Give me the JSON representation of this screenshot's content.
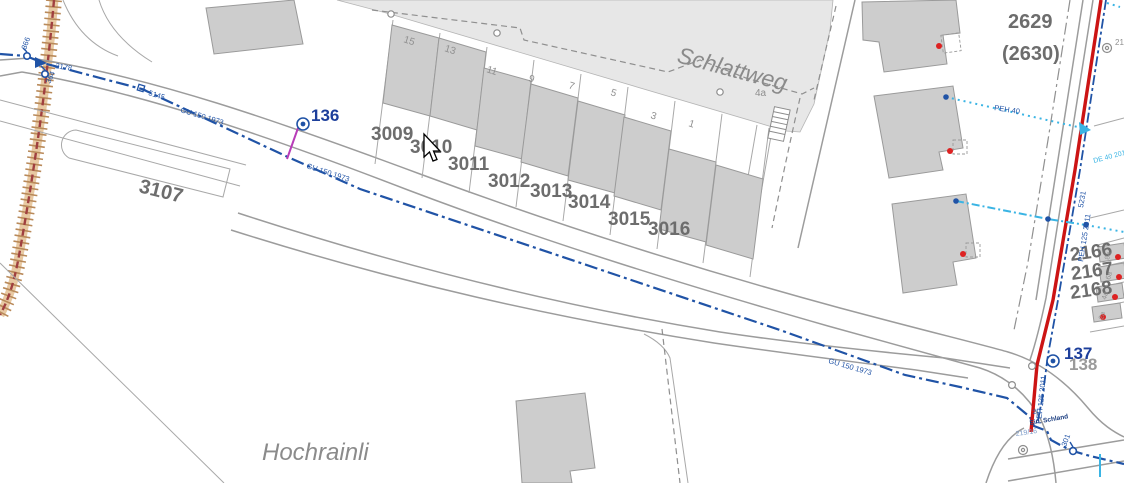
{
  "map": {
    "street_names": {
      "schlattweg": "Schlattweg",
      "hochrainli": "Hochrainli"
    },
    "parcels": {
      "p3107": "3107",
      "p3009": "3009",
      "p3010": "3010",
      "p3011": "3011",
      "p3012": "3012",
      "p3013": "3013",
      "p3014": "3014",
      "p3015": "3015",
      "p3016": "3016",
      "p2629": "2629",
      "p2630": "(2630)",
      "p2166": "2166",
      "p2167": "2167",
      "p2168": "2168"
    },
    "house_numbers": {
      "h15": "15",
      "h13": "13",
      "h11": "11",
      "h9": "9",
      "h7": "7",
      "h5": "5",
      "h3": "3",
      "h1": "1",
      "h4a": "4a",
      "ha8a": "8a",
      "ha6a": "6a",
      "ha4a": "4a",
      "ha2a": "2a"
    },
    "hydrants": {
      "hy136": "136",
      "hy137": "137",
      "hy138": "138"
    },
    "pipe_labels": {
      "gu150": "GU 150 1973",
      "peh125": "PEH 125 2011",
      "peh40": "PEH 40",
      "de40": "DE 40 2011"
    },
    "node_labels": {
      "n366": "366",
      "n364": "364",
      "n2178": "2178",
      "n5145": "5145",
      "n5231": "5231",
      "n301": "301",
      "n211": "211",
      "n21916": "219/16",
      "n21": "21",
      "schland": "Ein. Schland"
    },
    "colors": {
      "water_blue": "#2053a6",
      "cyan": "#3ab4e4",
      "main_red": "#cc1414",
      "magenta": "#b83cb8",
      "parcel_gray": "#6d6d6d",
      "text_gray": "#8b8b8b",
      "building_fill": "#cdcdcd",
      "road_fill": "#e7e7e7"
    }
  }
}
